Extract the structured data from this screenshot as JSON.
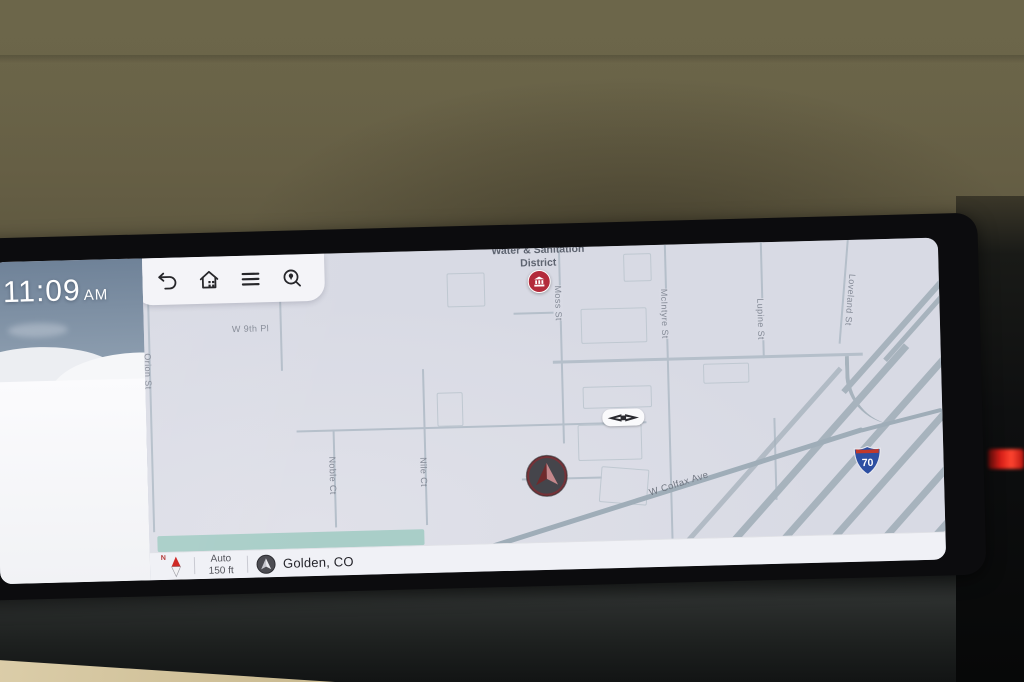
{
  "clock": {
    "time": "11:09",
    "meridiem": "AM"
  },
  "toolbar": {
    "icons": [
      "back-icon",
      "home-icon",
      "menu-icon",
      "search-icon"
    ]
  },
  "map": {
    "poi": {
      "line1": "Water & Sanitation",
      "line2": "District"
    },
    "streets": [
      "Orion St",
      "W 9th Pl",
      "Noble Ct",
      "Nile Ct",
      "Moss St",
      "McIntyre St",
      "Lupine St",
      "Loveland St",
      "W Colfax Ave"
    ],
    "shield": "70"
  },
  "status_bar": {
    "compass": "N",
    "mode": "Auto",
    "scale": "150 ft",
    "location": "Golden, CO"
  },
  "colors": {
    "accent_red": "#c23b44",
    "map_bg": "#d9dbe5",
    "road": "#b5bfca",
    "teal_strip": "#a9cec8",
    "shield_blue": "#2d4fa2",
    "shield_red": "#c0392b",
    "poi_red": "#b32b3b"
  }
}
